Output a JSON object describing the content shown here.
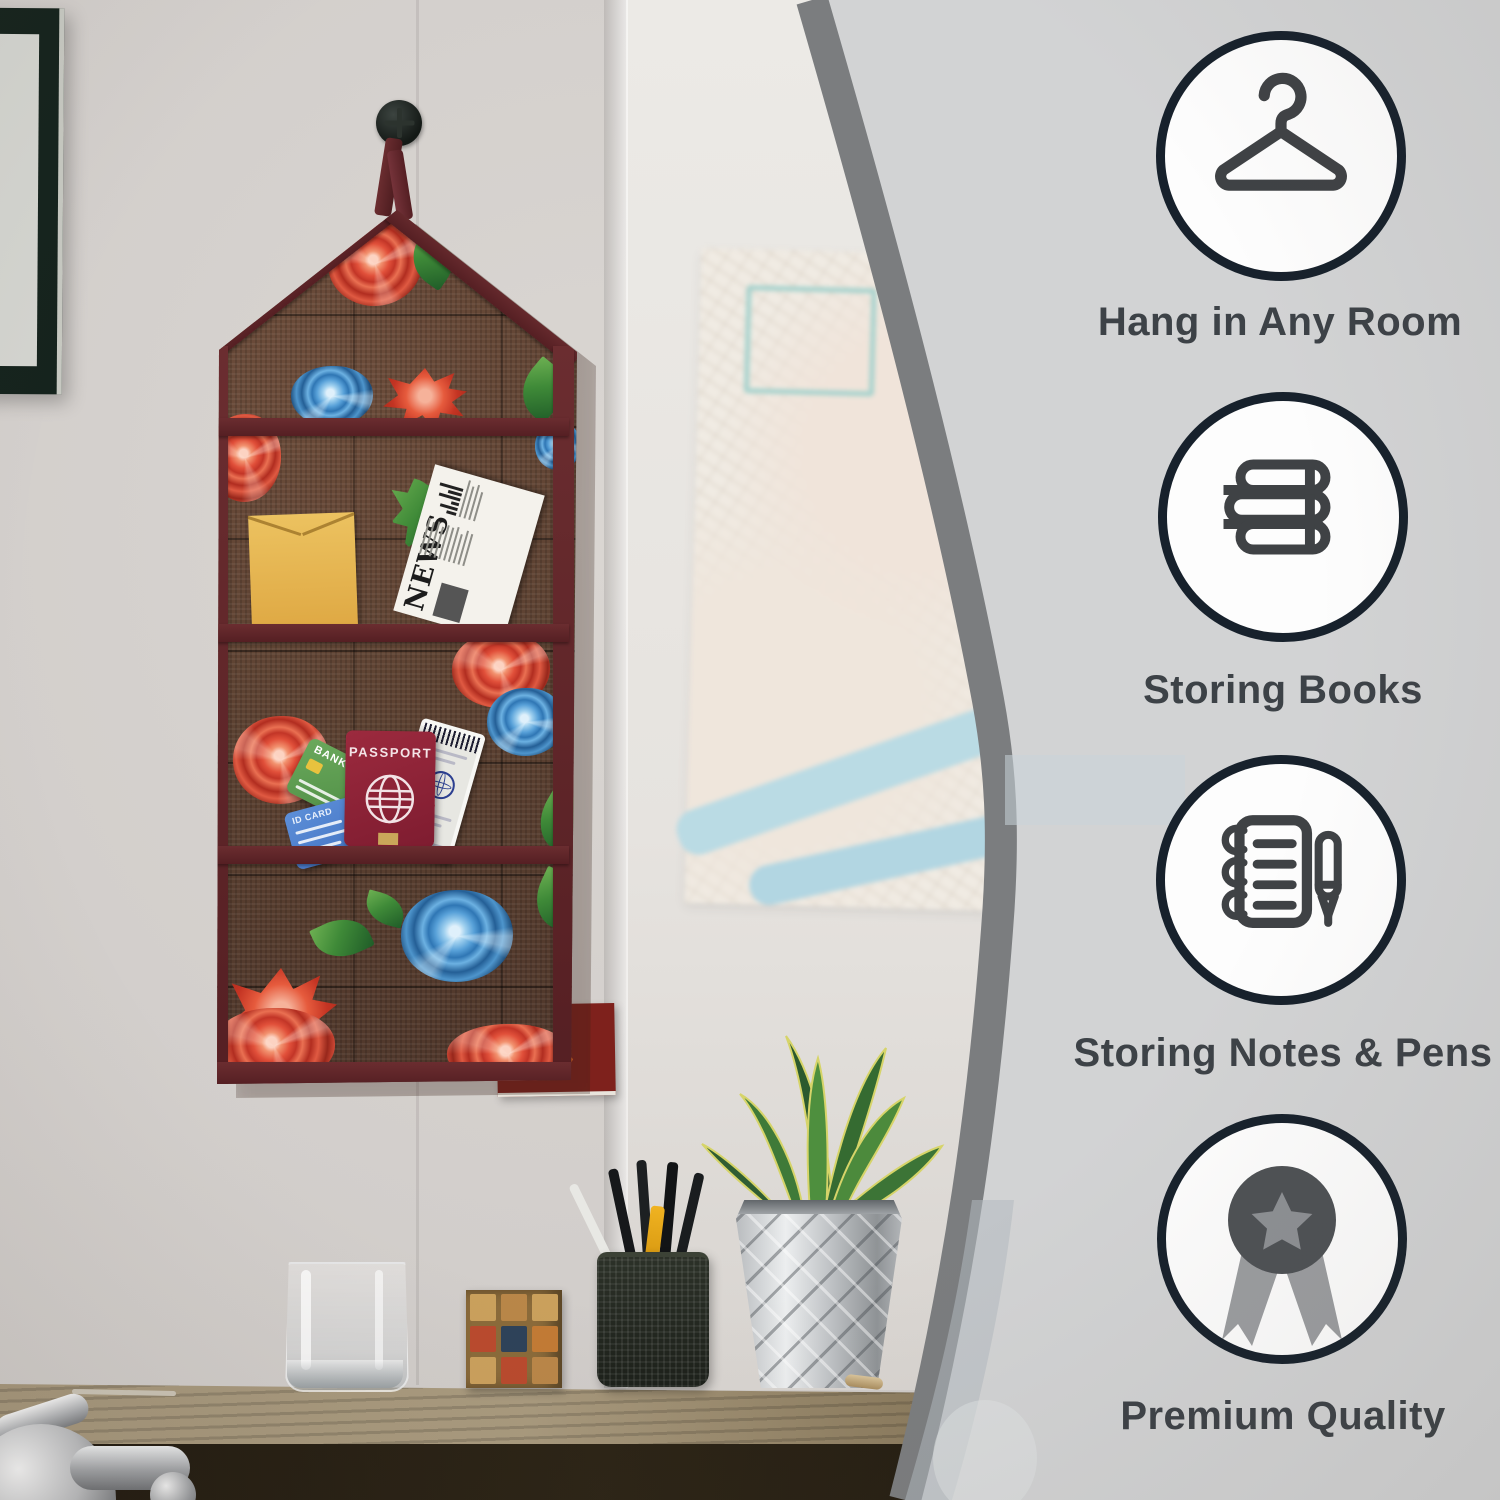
{
  "product": {
    "name": "Wall Hanging Pocket Organizer",
    "accent_color": "#5c2528",
    "fabric_color": "#5d4232",
    "print": "red-and-blue-roses-on-brown-jute",
    "pocket_count": 3,
    "items": {
      "newspaper_title": "NEWS",
      "passport_label": "PASSPORT",
      "bank_card_label": "BANK",
      "id_card_label": "ID CARD",
      "boarding_pass_label": "BOARDING PASS"
    }
  },
  "features": {
    "panel_bg": "#d2d3d4",
    "panel_edge": "#7b7d7f",
    "circle_border": "#17212c",
    "icon_color": "#3f4245",
    "label_color": "#3d4247",
    "items": [
      {
        "icon": "hanger-icon",
        "label": "Hang in Any Room"
      },
      {
        "icon": "books-icon",
        "label": "Storing Books"
      },
      {
        "icon": "notebook-pen-icon",
        "label": "Storing Notes & Pens"
      },
      {
        "icon": "medal-icon",
        "label": "Premium Quality"
      }
    ]
  },
  "scene": {
    "props": [
      "picture-frame",
      "city-map-poster",
      "red-fox-print",
      "drinking-glass",
      "wooden-puzzle-cube",
      "wire-pen-cup",
      "snake-plant-in-faceted-pot",
      "chrome-fixture",
      "wooden-desk"
    ]
  }
}
